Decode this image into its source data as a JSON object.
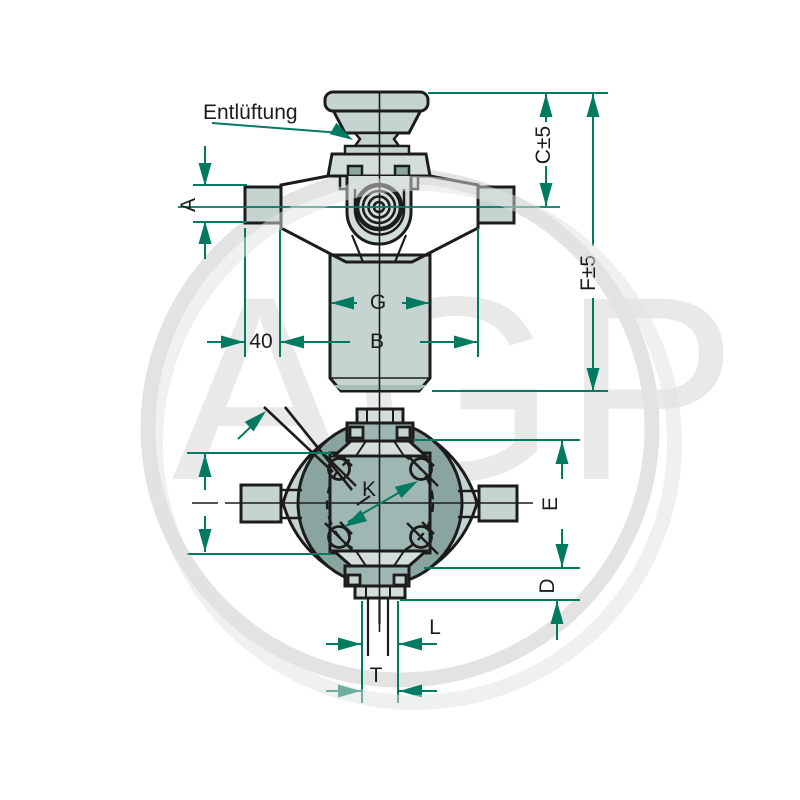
{
  "title": "Technical dimensional drawing of hydraulic master cylinder",
  "watermark": {
    "text": "AGP"
  },
  "colors": {
    "accent": "#007a60",
    "line": "#1c1c1c",
    "fill_light": "#c6d4d1",
    "fill_medium": "#9fb7b3",
    "fill_dark": "#8aa5a0",
    "fill_pale": "#d3deda",
    "watermark": "#e9e9e9",
    "background": "#ffffff"
  },
  "labels": {
    "vent": "Entlüftung",
    "a": "A",
    "c_tol": "C±5",
    "f_tol": "F±5",
    "g": "G",
    "b": "B",
    "forty": "40",
    "e": "E",
    "d": "D",
    "l": "L",
    "t": "T",
    "k": "K"
  }
}
